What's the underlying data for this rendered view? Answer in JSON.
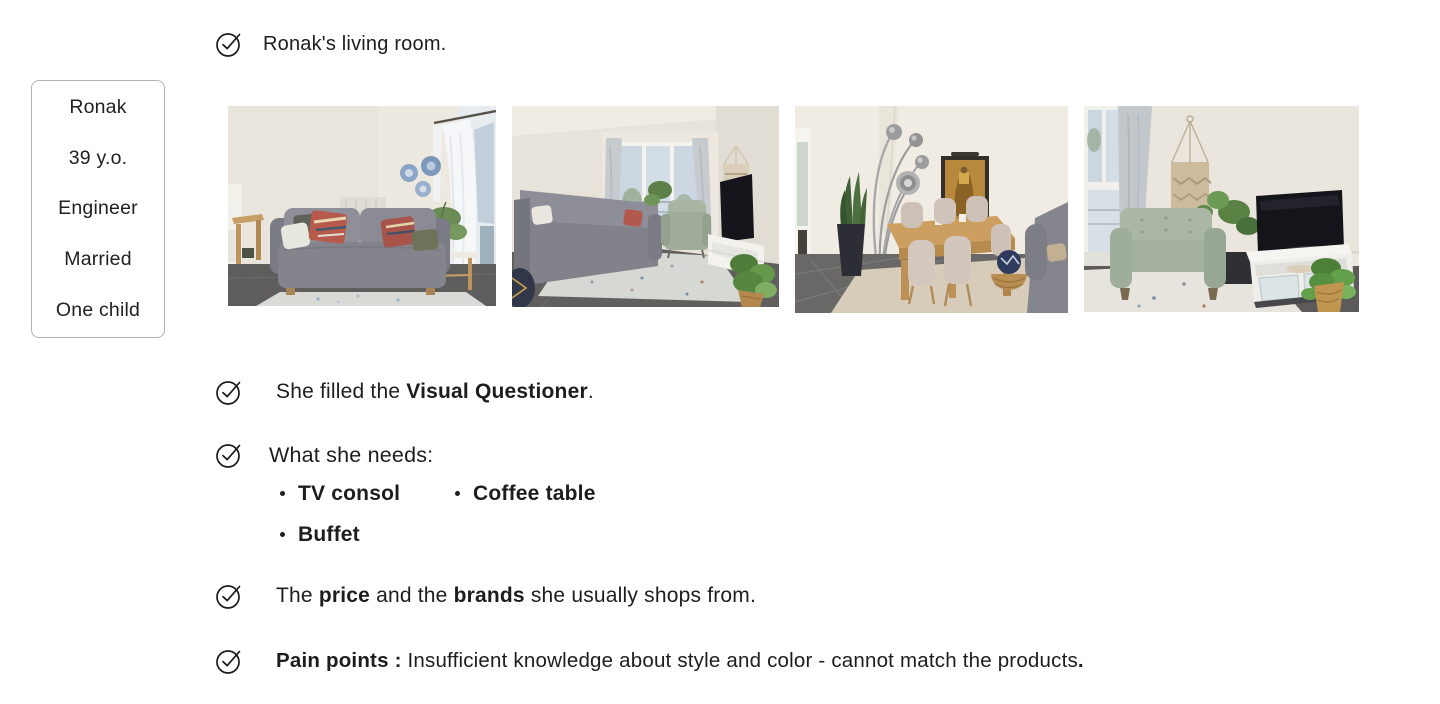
{
  "colors": {
    "text": "#1d1d1d",
    "card_border": "#b3b3b3",
    "background": "#ffffff"
  },
  "profile_card": {
    "lines": [
      "Ronak",
      "39 y.o.",
      "Engineer",
      "Married",
      "One child"
    ]
  },
  "checklist": [
    {
      "name": "living-room",
      "segments": [
        {
          "text": "Ronak's living room.",
          "bold": false
        }
      ]
    },
    {
      "name": "visual-questioner",
      "segments": [
        {
          "text": "She filled the ",
          "bold": false
        },
        {
          "text": "Visual Questioner",
          "bold": true
        },
        {
          "text": ".",
          "bold": false
        }
      ]
    },
    {
      "name": "needs",
      "segments": [
        {
          "text": "What she needs:",
          "bold": false
        }
      ]
    },
    {
      "name": "price-brands",
      "segments": [
        {
          "text": "The ",
          "bold": false
        },
        {
          "text": "price",
          "bold": true
        },
        {
          "text": " and the ",
          "bold": false
        },
        {
          "text": "brands",
          "bold": true
        },
        {
          "text": " she usually shops from.",
          "bold": false
        }
      ]
    },
    {
      "name": "pain-points",
      "segments": [
        {
          "text": "Pain points :",
          "bold": true
        },
        {
          "text": " Insufficient knowledge about style and color - cannot match the products",
          "bold": false
        },
        {
          "text": ".",
          "bold": true
        }
      ]
    }
  ],
  "needs": {
    "items": [
      "TV consol",
      "Coffee table",
      "Buffet"
    ]
  },
  "photos": [
    {
      "label": "grey sofa with kilim cushions, wall plates and window"
    },
    {
      "label": "living room overview with sofa, green armchair, TV and rug"
    },
    {
      "label": "dining area with oak table, beige chairs, arc lamp and golden painting"
    },
    {
      "label": "TV corner with sage armchair, white TV console, plants and macrame"
    }
  ],
  "icons": {
    "checkmark": "check-circle"
  }
}
